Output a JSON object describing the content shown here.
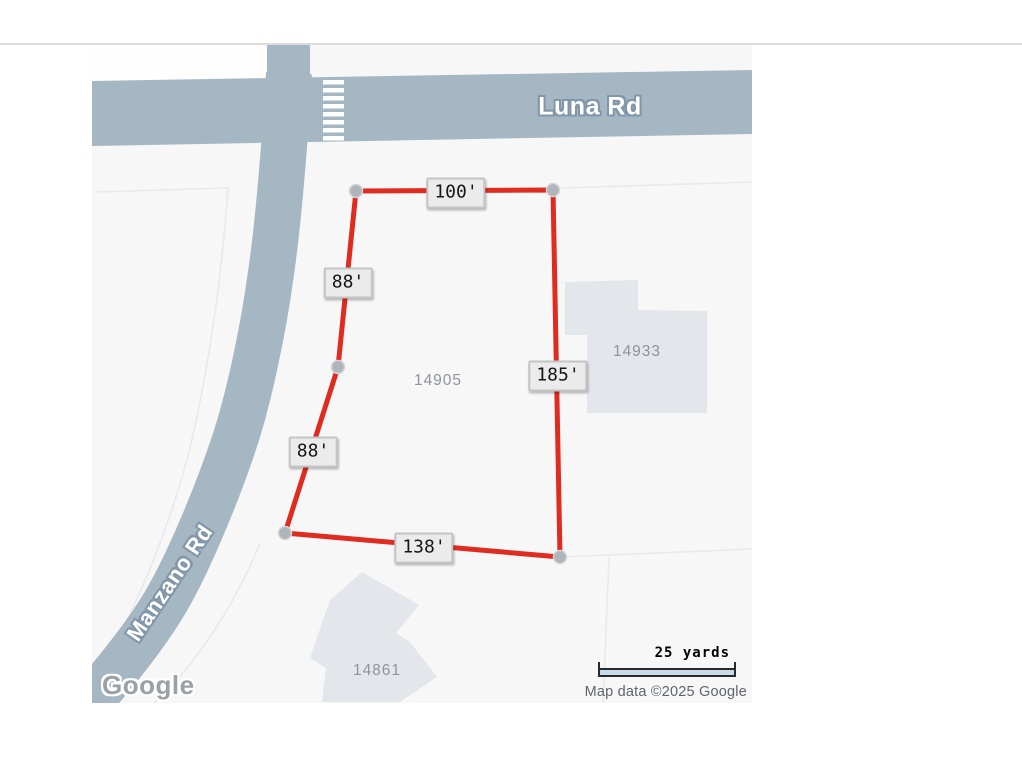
{
  "map": {
    "roads": [
      {
        "name": "Luna Rd"
      },
      {
        "name": "Manzano Rd"
      }
    ],
    "parcels": [
      {
        "id": "14905"
      },
      {
        "id": "14933"
      },
      {
        "id": "14861"
      }
    ],
    "dimension_labels": [
      {
        "text": "100'"
      },
      {
        "text": "88'"
      },
      {
        "text": "185'"
      },
      {
        "text": "88'"
      },
      {
        "text": "138'"
      }
    ],
    "scale": {
      "label": "25 yards"
    },
    "attribution": "Map data ©2025 Google",
    "logo": "Google",
    "colors": {
      "road": "#a6b7c4",
      "parcel_line": "#e8e9eb",
      "building": "#e3e6ea",
      "boundary_red": "#df2b20",
      "vertex_dot": "#b0b5bb",
      "label_bg": "#ebebeb",
      "map_bg": "#f7f7f8",
      "halo": "#8297a9",
      "muted_text": "#8f949c",
      "attr_text": "#5f646a"
    }
  }
}
